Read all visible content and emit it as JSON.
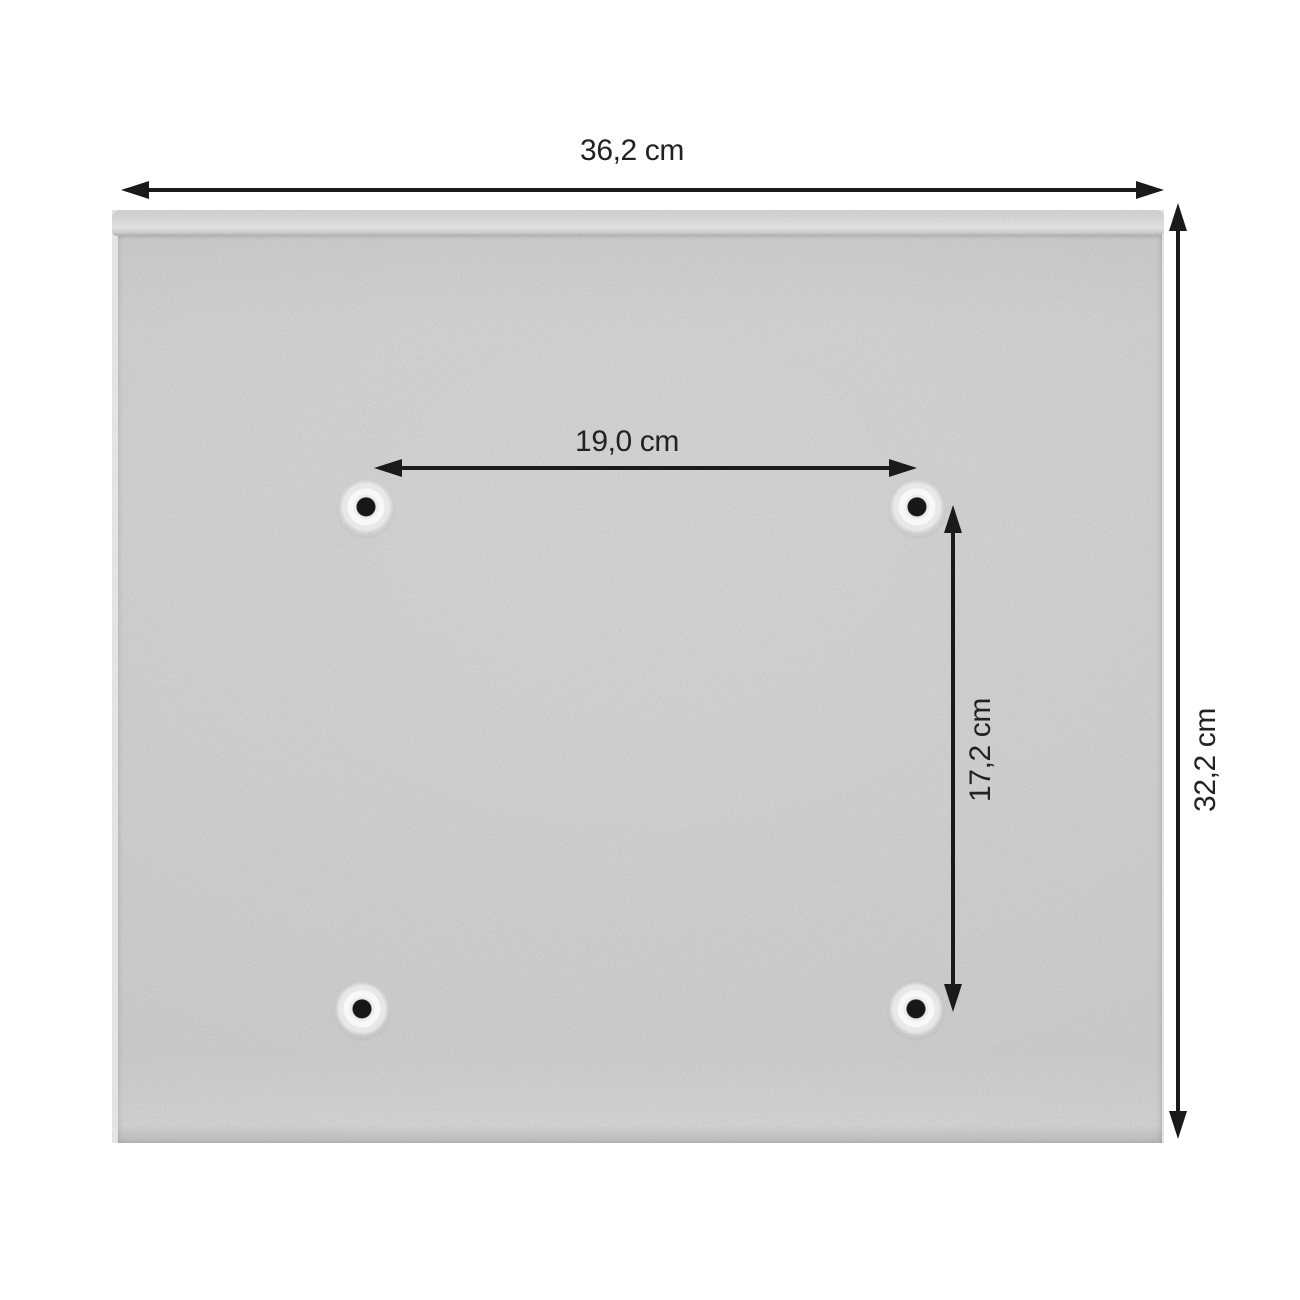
{
  "diagram": {
    "type": "product-dimension-diagram",
    "subject": "back panel with four mounting holes",
    "colors": {
      "background": "#ffffff",
      "panel-body": "#e3e3e3",
      "panel-lip": "#f2f2f2",
      "dim-line": "#1a1a1a",
      "dim-text": "#222222",
      "hole-center": "#171717"
    },
    "dimensions": {
      "overall_width": {
        "label": "36,2 cm",
        "orientation": "horizontal",
        "position": "top"
      },
      "overall_height": {
        "label": "32,2 cm",
        "orientation": "vertical",
        "position": "right"
      },
      "hole_spacing_horizontal": {
        "label": "19,0 cm",
        "orientation": "horizontal",
        "position": "between top mounting holes"
      },
      "hole_spacing_vertical": {
        "label": "17,2 cm",
        "orientation": "vertical",
        "position": "between right mounting holes"
      }
    },
    "mounting_holes_count": 4
  }
}
